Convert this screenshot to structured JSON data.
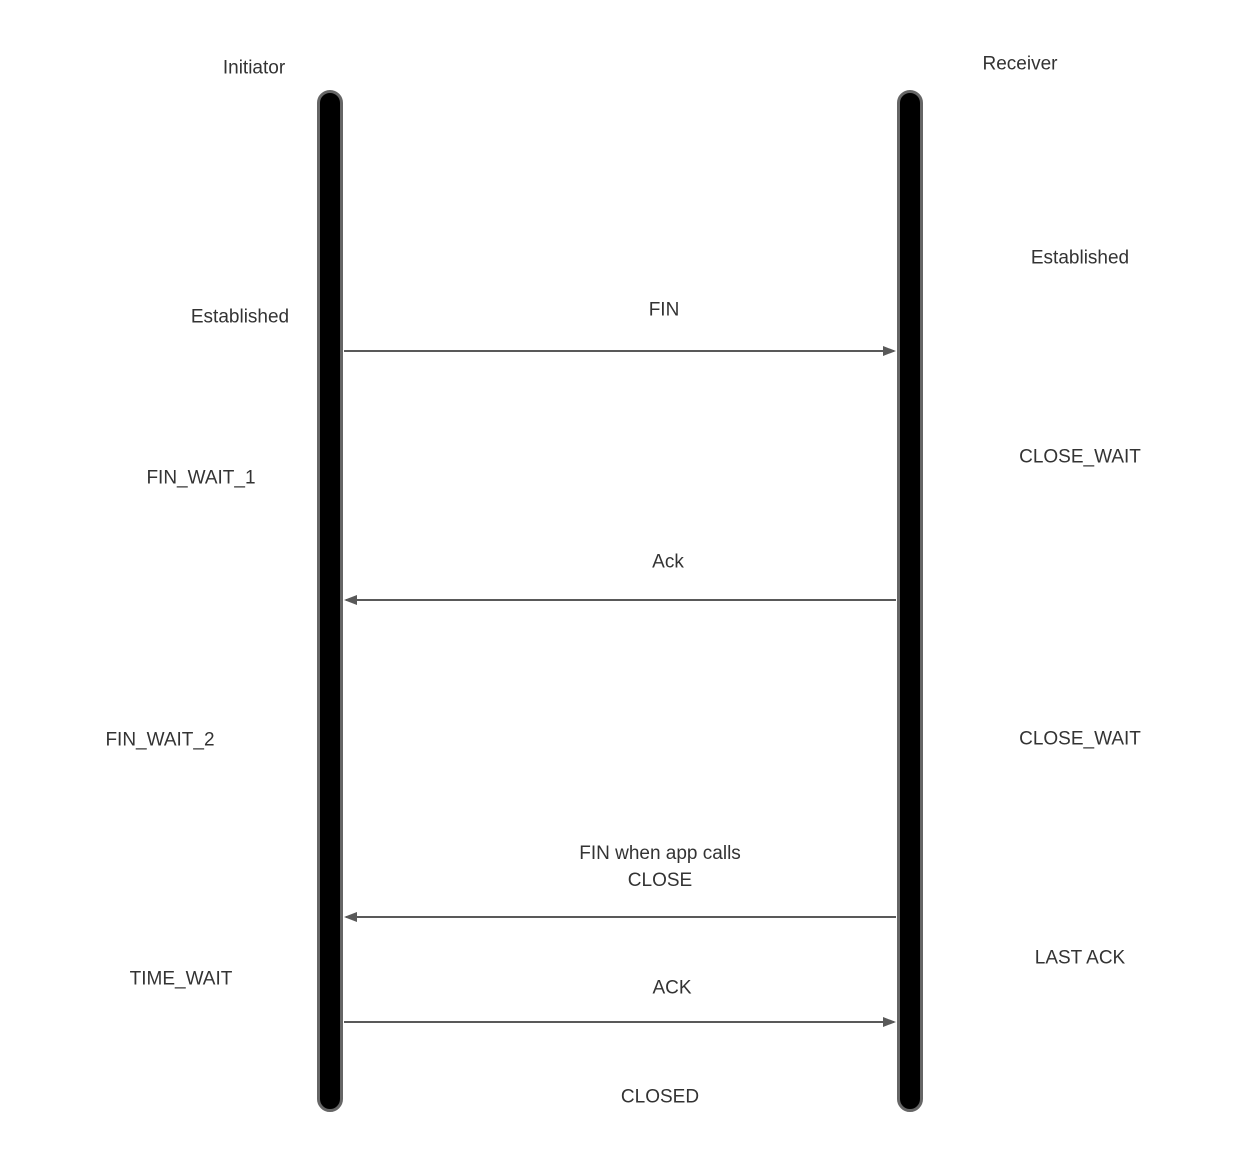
{
  "initiator": {
    "name": "Initiator",
    "states": [
      {
        "label": "Established"
      },
      {
        "label": "FIN_WAIT_1"
      },
      {
        "label": "FIN_WAIT_2"
      },
      {
        "label": "TIME_WAIT"
      }
    ]
  },
  "receiver": {
    "name": "Receiver",
    "states": [
      {
        "label": "Established"
      },
      {
        "label": "CLOSE_WAIT"
      },
      {
        "label": "CLOSE_WAIT"
      },
      {
        "label": "LAST ACK"
      }
    ]
  },
  "messages": [
    {
      "label": "FIN",
      "direction": "initiator-to-receiver"
    },
    {
      "label": "Ack",
      "direction": "receiver-to-initiator"
    },
    {
      "label": "FIN when app calls\nCLOSE",
      "direction": "receiver-to-initiator"
    },
    {
      "label": "ACK",
      "direction": "initiator-to-receiver"
    }
  ],
  "final_state": {
    "label": "CLOSED"
  },
  "colors": {
    "background": "#ffffff",
    "lifeline_fill": "#000000",
    "lifeline_border": "#666666",
    "arrow": "#595959",
    "text": "#333333"
  }
}
